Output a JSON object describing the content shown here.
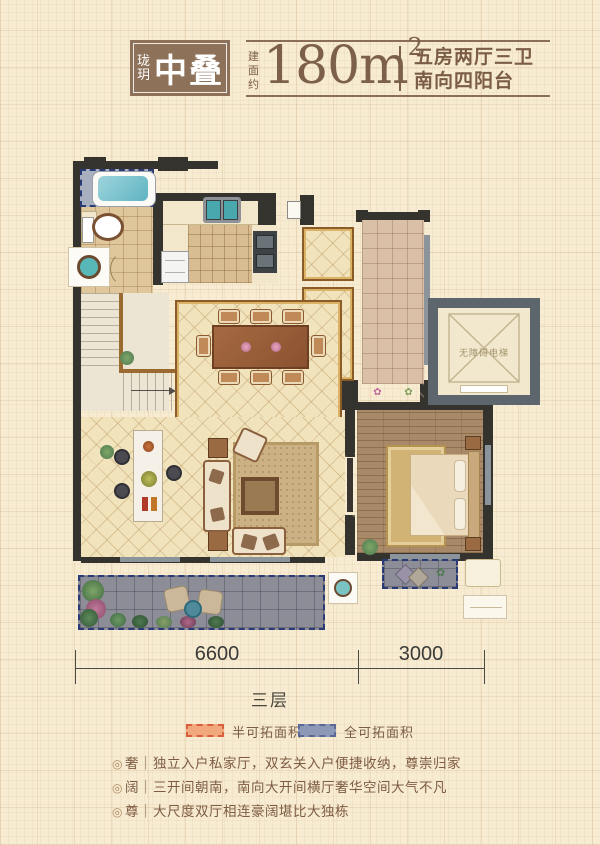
{
  "header": {
    "logo_small": "珑玥",
    "logo_large": "中叠",
    "area_prefix": "建面约",
    "area_value": "180m",
    "area_sup": "2",
    "info_line1": "五房两厅三卫",
    "info_line2": "南向四阳台"
  },
  "plan": {
    "elevator_label": "无障碍电梯",
    "planter_flower1": "✿",
    "planter_flower2": "✿",
    "balcony_flower": "✿"
  },
  "dimensions": {
    "left_span": "6600",
    "right_span": "3000",
    "floor_label": "三层"
  },
  "legend": [
    {
      "label": "半可拓面积",
      "color": "#f2a87d",
      "border": "#d95f3b"
    },
    {
      "label": "全可拓面积",
      "color": "#8c98b6",
      "border": "#5a6896"
    }
  ],
  "features": {
    "bullet_char": "◎",
    "separator": "｜",
    "items": [
      {
        "tag": "奢",
        "text": "独立入户私家厅，双玄关入户便捷收纳，尊崇归家"
      },
      {
        "tag": "阔",
        "text": "三开间朝南，南向大开间横厅奢华空间大气不凡"
      },
      {
        "tag": "尊",
        "text": "大尺度双厅相连豪阔堪比大独栋"
      }
    ]
  },
  "colors": {
    "brand_box_brown": "#8d7158",
    "text_brown": "#7b5c45",
    "wall_dark": "#35332e",
    "wall_gray": "#5d666d",
    "floor_tile": "#f1e3bc",
    "gold_trim": "#8a5c28",
    "terrace_gray": "#8d8d98",
    "expand_dash_navy": "#2a3a77",
    "legend_orange": "#f2a87d",
    "legend_blue": "#8c98b6",
    "water_teal": "#7ac3cf"
  }
}
